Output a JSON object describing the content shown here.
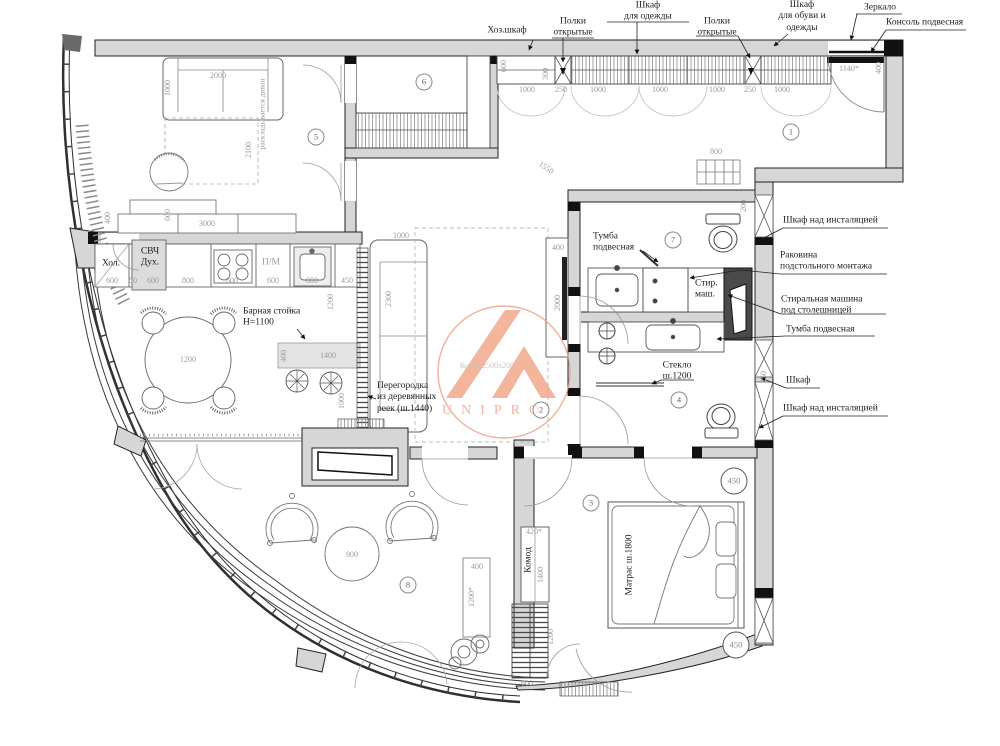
{
  "meta": {
    "type": "apartment-floor-plan",
    "language": "ru"
  },
  "watermark": {
    "brand": "UNIPRO",
    "accent_color": "#f0a183"
  },
  "colors": {
    "wall_fill": "#d6d6d6",
    "line": "#2f2f2f",
    "dim_text": "#9a9a9a",
    "callout_text": "#1c1c1c"
  },
  "callouts": [
    {
      "t": "Хоз.шкаф",
      "x": 507,
      "y": 31,
      "n": "label-utility-closet"
    },
    {
      "t": "Полки\nоткрытые",
      "x": 573,
      "y": 28,
      "n": "label-open-shelves-1"
    },
    {
      "t": "Шкаф\nдля одежды",
      "x": 648,
      "y": 12,
      "n": "label-clothes-wardrobe"
    },
    {
      "t": "Полки\nоткрытые",
      "x": 717,
      "y": 28,
      "n": "label-open-shelves-2"
    },
    {
      "t": "Шкаф\nдля обуви и\nодежды",
      "x": 802,
      "y": 17,
      "n": "label-shoe-wardrobe"
    },
    {
      "t": "Зеркало",
      "x": 880,
      "y": 8,
      "n": "label-mirror"
    },
    {
      "t": "Консоль подвесная",
      "x": 886,
      "y": 23,
      "cls": "la",
      "n": "label-console"
    },
    {
      "t": "Шкаф над инсталяцией",
      "x": 783,
      "y": 221,
      "cls": "la",
      "n": "label-cabinet-over-cistern-1"
    },
    {
      "t": "Раковина\nподстольного монтажа",
      "x": 780,
      "y": 262,
      "cls": "la",
      "n": "label-undermount-sink"
    },
    {
      "t": "Стиральная машина\nпод столешницей",
      "x": 781,
      "y": 306,
      "cls": "la",
      "n": "label-washing-machine"
    },
    {
      "t": "Тумба подвесная",
      "x": 786,
      "y": 330,
      "cls": "la",
      "n": "label-wall-vanity-right"
    },
    {
      "t": "Шкаф",
      "x": 786,
      "y": 381,
      "cls": "la",
      "n": "label-cabinet"
    },
    {
      "t": "Шкаф над инсталяцией",
      "x": 783,
      "y": 409,
      "cls": "la",
      "n": "label-cabinet-over-cistern-2"
    },
    {
      "t": "Тумба\nподвесная",
      "x": 593,
      "y": 243,
      "cls": "la",
      "n": "label-wall-vanity-mid"
    },
    {
      "t": "Стекло\nш.1200",
      "x": 677,
      "y": 372,
      "n": "label-glass-partition"
    },
    {
      "t": "Барная стойка\nН=1100",
      "x": 243,
      "y": 318,
      "cls": "la",
      "n": "label-bar-counter"
    },
    {
      "t": "Перегородка\nиз деревянных\nреек (ш.1440)",
      "x": 377,
      "y": 398,
      "cls": "la",
      "n": "label-slat-partition"
    },
    {
      "t": "Стир.\nмаш.",
      "x": 695,
      "y": 290,
      "cls": "la",
      "n": "label-washer-short"
    },
    {
      "t": "Хол.",
      "x": 111,
      "y": 264,
      "n": "label-fridge"
    },
    {
      "t": "СВЧ\nДух.",
      "x": 150,
      "y": 258,
      "n": "label-microwave-oven"
    },
    {
      "t": "П/М",
      "x": 271,
      "y": 263,
      "cls": "gray",
      "n": "label-dishwasher"
    },
    {
      "t": "Комод",
      "x": 529,
      "y": 560,
      "rot": -90,
      "n": "label-dresser"
    },
    {
      "t": "Матрас ш.1800",
      "x": 630,
      "y": 565,
      "rot": -90,
      "n": "label-mattress"
    },
    {
      "t": "Ковер 2500х2000",
      "x": 489,
      "y": 366,
      "cls": "light",
      "n": "label-carpet"
    },
    {
      "t": "раскладывается диван",
      "x": 262,
      "y": 114,
      "rot": -90,
      "cls": "small",
      "n": "label-sofa-unfolds"
    }
  ],
  "dimensions": [
    {
      "t": "1000",
      "x": 527,
      "y": 90
    },
    {
      "t": "250",
      "x": 561,
      "y": 90
    },
    {
      "t": "1000",
      "x": 598,
      "y": 90
    },
    {
      "t": "1000",
      "x": 660,
      "y": 90
    },
    {
      "t": "1000",
      "x": 717,
      "y": 90
    },
    {
      "t": "250",
      "x": 750,
      "y": 90
    },
    {
      "t": "1000",
      "x": 782,
      "y": 90
    },
    {
      "t": "600",
      "x": 504,
      "y": 66,
      "rot": -90
    },
    {
      "t": "300",
      "x": 546,
      "y": 74,
      "rot": -90
    },
    {
      "t": "1140*",
      "x": 849,
      "y": 69
    },
    {
      "t": "400",
      "x": 879,
      "y": 68,
      "rot": -90
    },
    {
      "t": "800",
      "x": 716,
      "y": 152
    },
    {
      "t": "200",
      "x": 744,
      "y": 206,
      "rot": -90
    },
    {
      "t": "1550",
      "x": 546,
      "y": 168,
      "rot": 33
    },
    {
      "t": "2000",
      "x": 218,
      "y": 76
    },
    {
      "t": "1000",
      "x": 168,
      "y": 88,
      "rot": -90
    },
    {
      "t": "2100",
      "x": 249,
      "y": 150,
      "rot": -90
    },
    {
      "t": "400",
      "x": 108,
      "y": 218,
      "rot": -90
    },
    {
      "t": "600",
      "x": 168,
      "y": 215,
      "rot": -90
    },
    {
      "t": "3000",
      "x": 207,
      "y": 224
    },
    {
      "t": "600",
      "x": 112,
      "y": 281
    },
    {
      "t": "50",
      "x": 133,
      "y": 281
    },
    {
      "t": "600",
      "x": 153,
      "y": 281
    },
    {
      "t": "800",
      "x": 188,
      "y": 281
    },
    {
      "t": "800",
      "x": 232,
      "y": 281
    },
    {
      "t": "600",
      "x": 273,
      "y": 281
    },
    {
      "t": "800",
      "x": 312,
      "y": 281
    },
    {
      "t": "450",
      "x": 347,
      "y": 281
    },
    {
      "t": "1200",
      "x": 331,
      "y": 302,
      "rot": -90
    },
    {
      "t": "1200",
      "x": 188,
      "y": 360
    },
    {
      "t": "400",
      "x": 284,
      "y": 356,
      "rot": -90
    },
    {
      "t": "1400",
      "x": 328,
      "y": 356
    },
    {
      "t": "1000",
      "x": 342,
      "y": 401,
      "rot": -90
    },
    {
      "t": "1000",
      "x": 401,
      "y": 236
    },
    {
      "t": "2300",
      "x": 389,
      "y": 299,
      "rot": -90
    },
    {
      "t": "400",
      "x": 558,
      "y": 248
    },
    {
      "t": "2000",
      "x": 558,
      "y": 303,
      "rot": -90
    },
    {
      "t": "250",
      "x": 764,
      "y": 377,
      "rot": -90
    },
    {
      "t": "420*",
      "x": 534,
      "y": 532
    },
    {
      "t": "1400",
      "x": 541,
      "y": 575,
      "rot": -90
    },
    {
      "t": "1200",
      "x": 551,
      "y": 637,
      "rot": -90
    },
    {
      "t": "600",
      "x": 527,
      "y": 684
    },
    {
      "t": "400",
      "x": 477,
      "y": 567
    },
    {
      "t": "1200*",
      "x": 472,
      "y": 597,
      "rot": -90
    },
    {
      "t": "900",
      "x": 352,
      "y": 555
    }
  ],
  "room_numbers": [
    {
      "t": "1",
      "x": 791,
      "y": 132
    },
    {
      "t": "2",
      "x": 541,
      "y": 410
    },
    {
      "t": "3",
      "x": 591,
      "y": 503
    },
    {
      "t": "4",
      "x": 679,
      "y": 400
    },
    {
      "t": "5",
      "x": 316,
      "y": 137
    },
    {
      "t": "6",
      "x": 424,
      "y": 82
    },
    {
      "t": "7",
      "x": 673,
      "y": 240
    },
    {
      "t": "8",
      "x": 408,
      "y": 585
    }
  ],
  "column_diameters": [
    {
      "t": "450",
      "x": 734,
      "y": 481
    },
    {
      "t": "450",
      "x": 736,
      "y": 645
    }
  ]
}
